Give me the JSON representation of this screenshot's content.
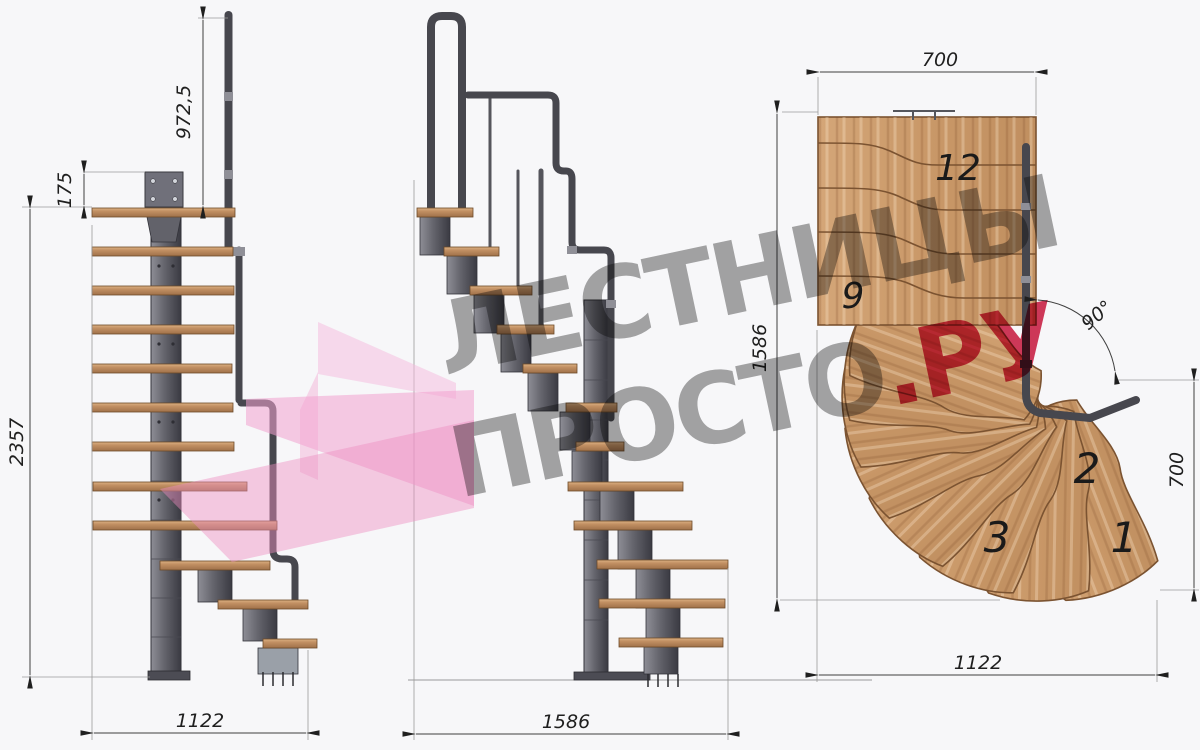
{
  "drawing": {
    "type": "modular-staircase technical drawing, three views",
    "front_view": {
      "dim_rail_height": "972,5",
      "dim_plate_offset": "175",
      "dim_total_height": "2357",
      "dim_width": "1122"
    },
    "side_view": {
      "dim_width": "1586"
    },
    "plan_view": {
      "dim_top_width": "700",
      "dim_left_depth": "1586",
      "dim_right_depth": "700",
      "dim_bottom_width": "1122",
      "dim_turn_angle": "90°",
      "step_labels": {
        "s12": "12",
        "s9": "9",
        "s3": "3",
        "s2": "2",
        "s1": "1"
      }
    },
    "watermark": {
      "line1": "ЛЕСТНИЦЫ",
      "line2_gray": "ПРОСТО",
      "line2_red": ".РУ"
    },
    "colors": {
      "background": "#f7f7f9",
      "wood": "#cb9b6e",
      "wood_dark": "#7b5331",
      "steel": "#64646c",
      "rail": "#47474e",
      "watermark_gray": "#a6a6a6",
      "watermark_red": "#d43a5a",
      "watermark_pink": "#f2a2cf"
    }
  }
}
